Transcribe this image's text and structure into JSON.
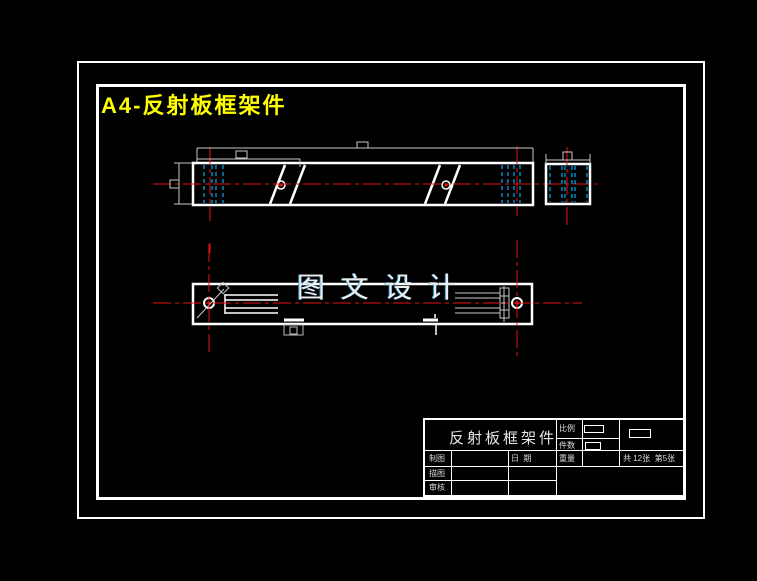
{
  "drawing": {
    "sheet_title": "A4-反射板框架件",
    "watermark": "图 文 设 计"
  },
  "title_block": {
    "part_name": "反射板框架件",
    "labels": {
      "scale": "比例",
      "quantity": "件数",
      "weight": "重量",
      "drafted_by": "制图",
      "date": "日  期",
      "traced_by": "描图",
      "checked_by": "审核"
    },
    "sheet_count": "共 12张  第5张"
  },
  "colors": {
    "background": "#000000",
    "outline": "#ffffff",
    "centerline_red": "#e81212",
    "hidden_line_cyan": "#00aeef",
    "dimension_gray": "#c8c8c8",
    "sheet_title_yellow": "#ffff00"
  }
}
